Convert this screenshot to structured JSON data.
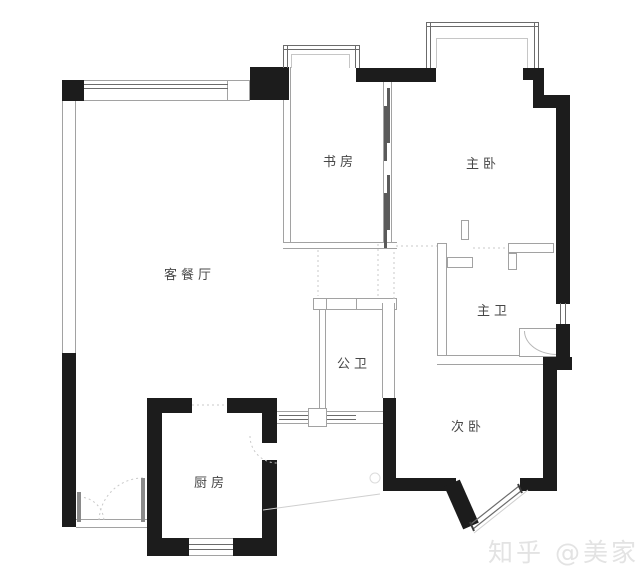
{
  "floorplan": {
    "rooms": {
      "living_dining": {
        "label": "客餐厅"
      },
      "study": {
        "label": "书房"
      },
      "master_bedroom": {
        "label": "主卧"
      },
      "master_bathroom": {
        "label": "主卫"
      },
      "guest_bathroom": {
        "label": "公卫"
      },
      "second_bedroom": {
        "label": "次卧"
      },
      "kitchen": {
        "label": "厨房"
      }
    },
    "watermark": {
      "text": "知乎 @美家手记"
    },
    "colors": {
      "wall": "#1c1c1c",
      "thin_line": "#a2a2a2",
      "window_line": "#6b6b6b",
      "label_text": "#474747",
      "watermark": "#e3e3e3"
    }
  }
}
